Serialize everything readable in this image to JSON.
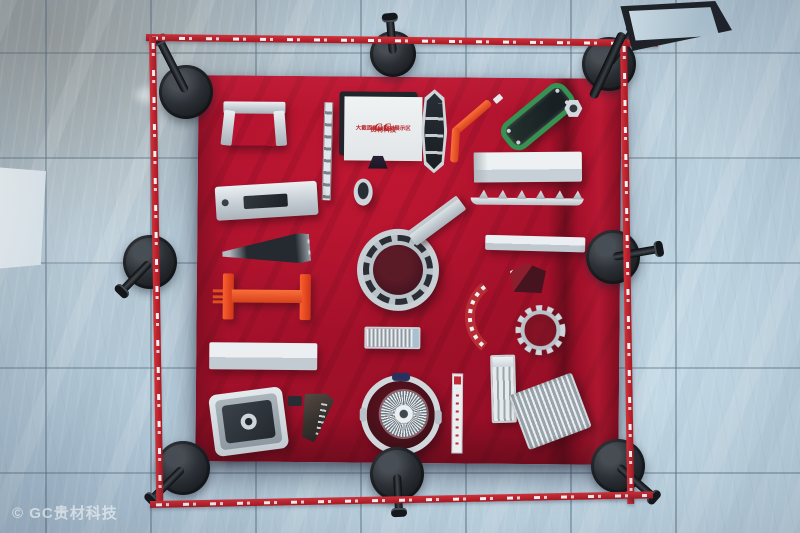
{
  "photo": {
    "watermark": "© GC贵材科技",
    "exhibit_sign": {
      "logo": "GC",
      "brand": "贵材铝材",
      "title": "贵材科技",
      "subtitle": "大截面工业型材展示区"
    },
    "colors": {
      "cloth_red": "#AF0721",
      "tape_red": "#C41A22",
      "floor_blue_gray": "#B7CBD8",
      "stanchion_black": "#1A1D21",
      "aluminum": "#CCD3D8",
      "accent_orange": "#E8491E",
      "accent_green": "#2E8F4A",
      "info_sign_face": "#C9DDE9"
    }
  }
}
